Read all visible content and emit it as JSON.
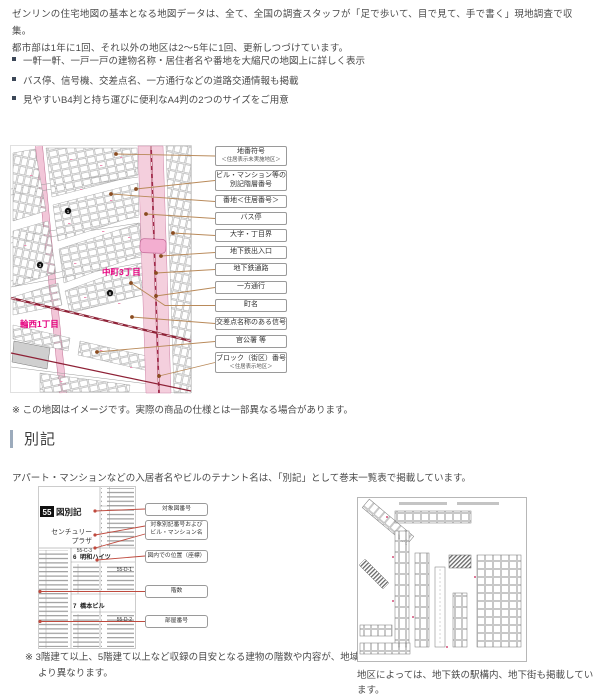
{
  "intro": {
    "line1": "ゼンリンの住宅地図の基本となる地図データは、全て、全国の調査スタッフが「足で歩いて、目で見て、手で書く」現地調査で収集。",
    "line2": "都市部は1年に1回、それ以外の地区は2〜5年に1回、更新しつづけています。"
  },
  "features": [
    "一軒一軒、一戸一戸の建物名称・居住者名や番地を大縮尺の地図上に詳しく表示",
    "バス停、信号機、交差点名、一方通行などの道路交通情報も掲載",
    "見やすいB4判と持ち運びに便利なA4判の2つのサイズをご用意"
  ],
  "map_figure": {
    "district_center": "中町3丁目",
    "district_bottom": "輪西1丁目",
    "markers": [
      "1",
      "3",
      "6"
    ],
    "callouts": [
      {
        "line1": "地番符号",
        "line2": "＜住居表示未実施地区＞"
      },
      {
        "line1": "ビル・マンション等の",
        "line2": "別記階層番号"
      },
      {
        "line1": "番地＜住居番号＞"
      },
      {
        "line1": "バス停"
      },
      {
        "line1": "大字・丁目界"
      },
      {
        "line1": "地下鉄出入口"
      },
      {
        "line1": "地下鉄通路"
      },
      {
        "line1": "一方通行"
      },
      {
        "line1": "町名"
      },
      {
        "line1": "交差点名称のある信号"
      },
      {
        "line1": "官公署 等"
      },
      {
        "line1": "ブロック（街区）番号",
        "line2": "＜住居表示地区＞"
      }
    ],
    "note": "※ この地図はイメージです。実際の商品の仕様とは一部異なる場合があります。"
  },
  "bekki": {
    "title": "別記",
    "body": "アパート・マンションなどの入居者名やビルのテナント名は、「別記」として巻末一覧表で掲載しています。",
    "figure": {
      "page_no": "55",
      "page_label": "図別記",
      "b1_line1": "センチュリー",
      "b1_line2": "プラザ",
      "b1_code": "55-C-3",
      "e2_no": "6",
      "e2_name": "明和ハイツ",
      "e2_code": "55-D-1",
      "e3_no": "7",
      "e3_name": "橋本ビル",
      "e3_code": "55-D-2"
    },
    "callouts": [
      {
        "line1": "対象図番号"
      },
      {
        "line1": "対象別記番号および",
        "line2": "ビル・マンション名"
      },
      {
        "line1": "図内での位置（座標）"
      },
      {
        "line1": "階数"
      },
      {
        "line1": "部屋番号"
      }
    ],
    "note": "※ 3階建て以上、5階建て以上など収録の目安となる建物の階数や内容が、地域により異なります。"
  },
  "chika": {
    "caption": "地区によっては、地下鉄の駅構内、地下街も掲載しています。"
  },
  "colors": {
    "accent_magenta": "#e5007f",
    "road_pink": "#f4cfdd",
    "rail_red": "#8e2136",
    "connector_brown": "#b98a5a",
    "connector_red": "#bf4a3e"
  }
}
